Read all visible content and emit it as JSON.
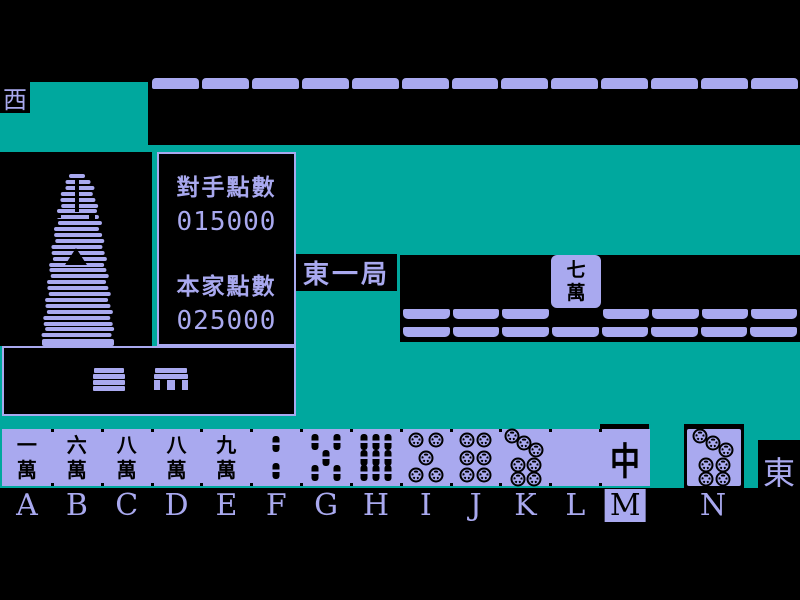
{
  "colors": {
    "table_teal": "#00a89e",
    "tile_lavender": "#a9a9ef",
    "background_black": "#000000",
    "tile_ink": "#000000"
  },
  "seats": {
    "west": "西",
    "east": "東"
  },
  "round": {
    "label": "東一局"
  },
  "scores": {
    "opponent_label": "對手點數",
    "opponent_value": "015000",
    "player_label": "本家點數",
    "player_value": "025000"
  },
  "opponent_area": {
    "discard_tile": {
      "label_top": "七",
      "label_bottom": "萬",
      "name": "7-man"
    },
    "wall_top_count": 13,
    "rack_row1_left": 3,
    "rack_row1_right": 4,
    "rack_row2": 8
  },
  "hand": {
    "tiles": [
      {
        "letter": "A",
        "suit": "man",
        "label": "一萬",
        "name": "1-man"
      },
      {
        "letter": "B",
        "suit": "man",
        "label": "六萬",
        "name": "6-man"
      },
      {
        "letter": "C",
        "suit": "man",
        "label": "八萬",
        "name": "8-man"
      },
      {
        "letter": "D",
        "suit": "man",
        "label": "八萬",
        "name": "8-man"
      },
      {
        "letter": "E",
        "suit": "man",
        "label": "九萬",
        "name": "9-man"
      },
      {
        "letter": "F",
        "suit": "sou",
        "count": 2,
        "name": "2-bamboo"
      },
      {
        "letter": "G",
        "suit": "sou",
        "count": 5,
        "name": "5-bamboo"
      },
      {
        "letter": "H",
        "suit": "sou",
        "count": 9,
        "name": "9-bamboo"
      },
      {
        "letter": "I",
        "suit": "pin",
        "count": 5,
        "name": "5-circle"
      },
      {
        "letter": "J",
        "suit": "pin",
        "count": 6,
        "name": "6-circle"
      },
      {
        "letter": "K",
        "suit": "pin",
        "count": 7,
        "name": "7-circle"
      },
      {
        "letter": "L",
        "suit": "blank",
        "name": "white-dragon"
      },
      {
        "letter": "M",
        "suit": "honor",
        "label": "中",
        "name": "red-dragon",
        "selected": true
      }
    ],
    "drawn": {
      "letter": "N",
      "suit": "pin",
      "count": 7,
      "name": "7-circle"
    },
    "selected_letter": "M"
  }
}
